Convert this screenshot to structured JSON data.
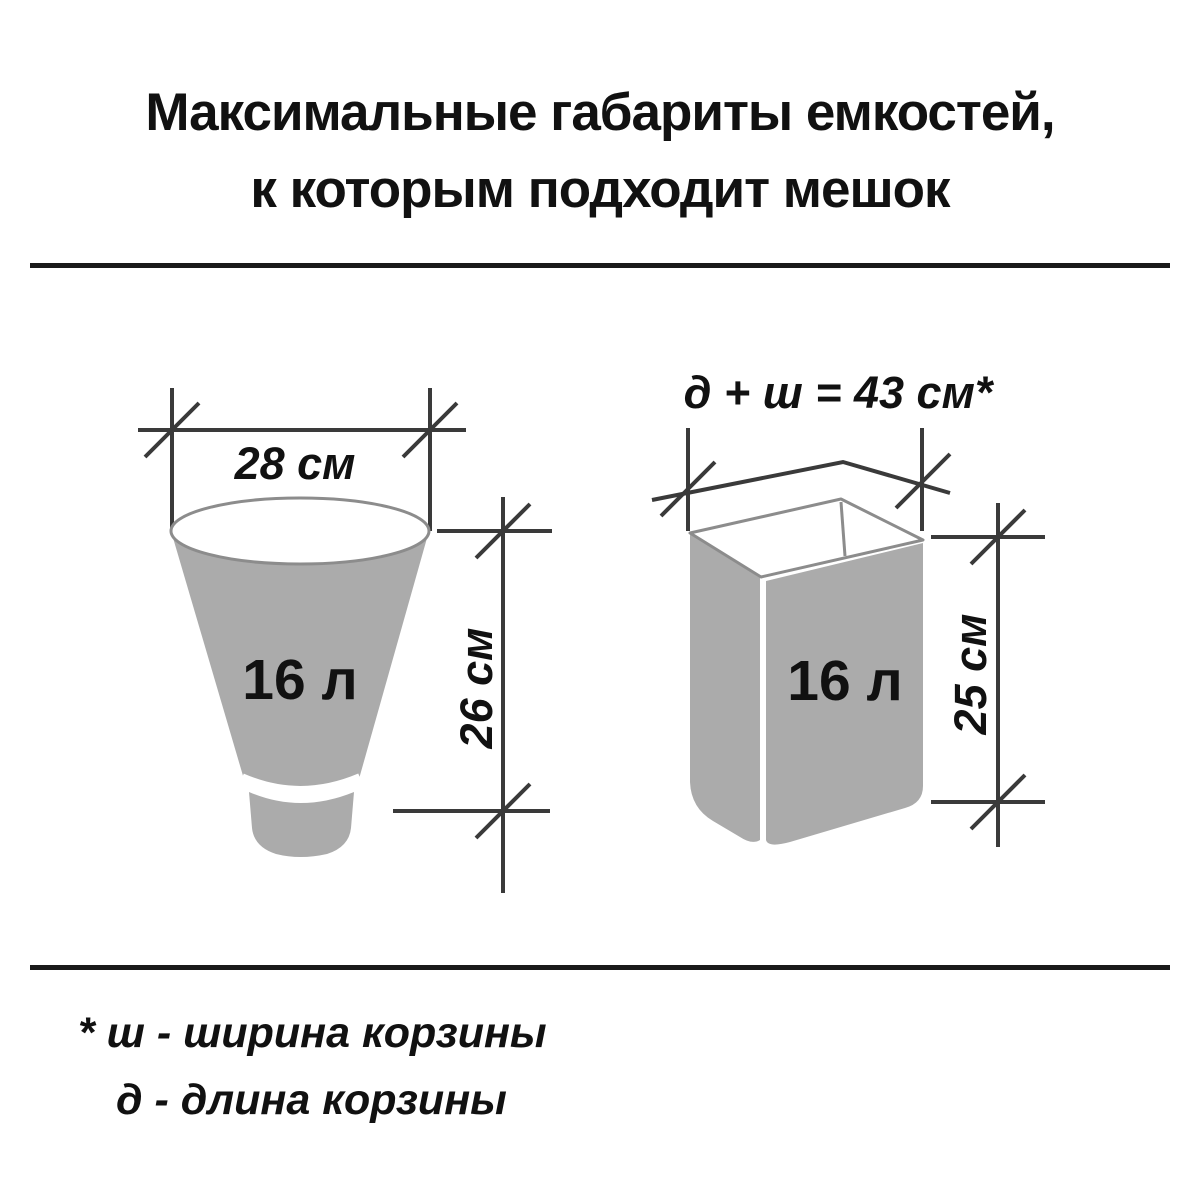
{
  "title": {
    "line1": "Максимальные габариты емкостей,",
    "line2": "к которым подходит мешок"
  },
  "left_diagram": {
    "shape": "round-bucket",
    "width_label": "28 см",
    "volume_label": "16 л",
    "height_label": "26 см"
  },
  "right_diagram": {
    "shape": "rectangular-basket",
    "formula_label": "д + ш = 43 см*",
    "volume_label": "16 л",
    "height_label": "25 см"
  },
  "footnote": {
    "line1": "* ш - ширина корзины",
    "line2": "д - длина корзины"
  },
  "colors": {
    "container_fill": "#ababab",
    "container_outline": "#8c8c8c",
    "dimension_line": "#3a3a3a",
    "text": "#111111",
    "background": "#ffffff"
  }
}
